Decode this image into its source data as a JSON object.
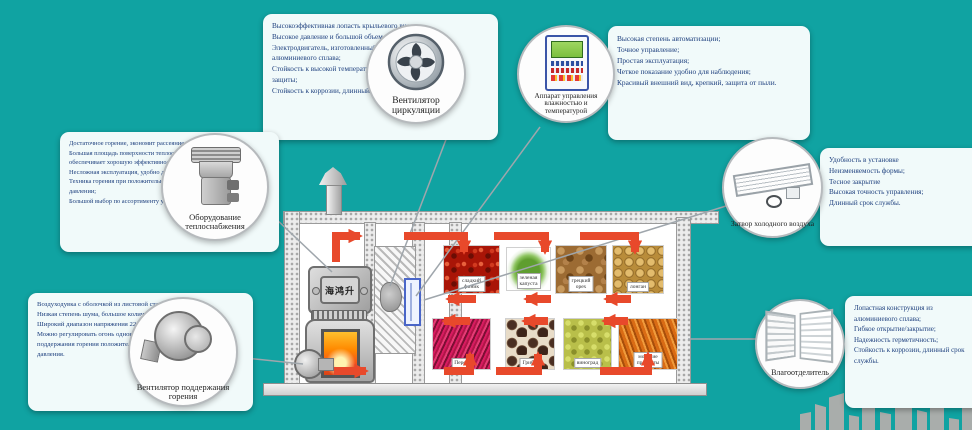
{
  "colors": {
    "background": "#10a3a2",
    "arrow_red": "#e8492b",
    "box_text": "#1c3e7d"
  },
  "callouts": {
    "fan_circulation": {
      "label": "Вентилятор циркуляции",
      "features": [
        "Высокоэффективная лопасть крыльевого вида;",
        "Высокое давление и большой объем воздуха;",
        "Электродвигатель, изготовленный полностью из алюминиевого сплава;",
        "Стойкость к высокой температуре; высокая категория защиты;",
        "Стойкость к коррозии, длинный срок службы."
      ]
    },
    "control_apparatus": {
      "label": "Аппарат управления влажностью и температурой",
      "features": [
        "Высокая степень автоматизации;",
        "Точное управление;",
        "Простая эксплуатация;",
        "Четкое показание удобно для наблюдения;",
        "Красивый внешний вид, крепкий, защита от пыли."
      ]
    },
    "heating_equipment": {
      "label": "Оборудование теплоснабжения",
      "features": [
        "Достаточное горение, экономит рассеяние топлива;",
        "Большая площадь поверхности теплообмена обеспечивает хорошую эффективность теплообмена;",
        "Несложная эксплуатация, удобно для очистки;",
        "Техника горения при положительном/отрицательном давлении;",
        "Большой выбор по ассортименту угля."
      ]
    },
    "cold_air_valve": {
      "label": "Затвор холодного воздуха",
      "features": [
        "Удобность в установке",
        "Неизменяемость формы;",
        "Тесное закрытие",
        "Высокая точность управления;",
        "Длинный срок службы."
      ]
    },
    "combustion_fan": {
      "label": "Вентилятор поддержания горения",
      "features": [
        "Воздуходувка с оболочкой из листовой стали;",
        "Низкая степень шума, большое количество дутья;",
        "Широкий диапазон напряжения 220В+/-20%;",
        "Можно регулировать огонь одновременно вентилятора поддержания горения положительного и отрицательного давления."
      ]
    },
    "moisture_separator": {
      "label": "Влагоотделитель",
      "features": [
        "Лопастная конструкция из алюминиевого сплава;",
        "Гибкое открытие/закрытие;",
        "Надежность герметичность;",
        "Стойкость к коррозии, длинный срок службы."
      ]
    }
  },
  "diagram": {
    "stove_plate_text": "海鸿升",
    "products_top": [
      {
        "label": "сладкий финик"
      },
      {
        "label": "зеленая капуста"
      },
      {
        "label": "грецкий орех"
      },
      {
        "label": "лонган"
      }
    ],
    "products_bottom": [
      {
        "label": "Перец"
      },
      {
        "label": "Грибы"
      },
      {
        "label": "виноград"
      },
      {
        "label": "морские продукты"
      }
    ]
  }
}
